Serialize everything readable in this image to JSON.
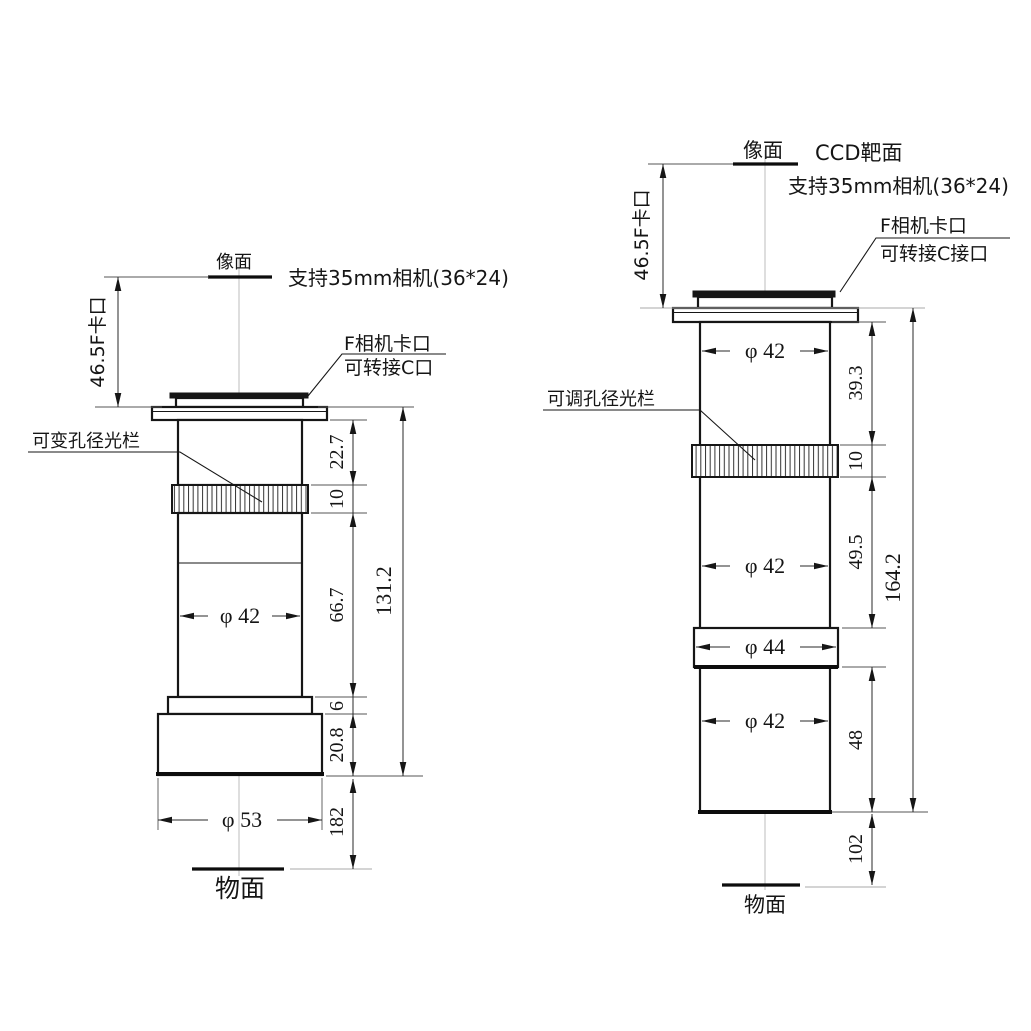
{
  "drawing": {
    "left": {
      "image_plane": "像面",
      "object_plane": "物面",
      "camera_note": "支持35mm相机(36*24)",
      "flange_label": "46.5F卡口",
      "mount_note_1": "F相机卡口",
      "mount_note_2": "可转接C口",
      "aperture_label": "可变孔径光栏",
      "dia_barrel": "φ 42",
      "dia_base": "φ 53",
      "dim_flange_to_knurl": "22.7",
      "dim_knurl": "10",
      "dim_barrel": "66.7",
      "dim_step": "6",
      "dim_base": "20.8",
      "dim_overall": "131.2",
      "dim_object_distance": "182"
    },
    "right": {
      "image_plane": "像面",
      "object_plane": "物面",
      "ccd_label": "CCD靶面",
      "camera_note": "支持35mm相机(36*24)",
      "flange_label": "46.5F卡口",
      "mount_note_1": "F相机卡口",
      "mount_note_2": "可转接C接口",
      "aperture_label": "可调孔径光栏",
      "dia_top": "φ 42",
      "dia_mid": "φ 42",
      "dia_ring": "φ 44",
      "dia_bottom": "φ 42",
      "dim_flange_to_knurl": "39.3",
      "dim_knurl": "10",
      "dim_mid_barrel": "49.5",
      "dim_bottom_barrel": "48",
      "dim_overall": "164.2",
      "dim_object_distance": "102"
    }
  }
}
